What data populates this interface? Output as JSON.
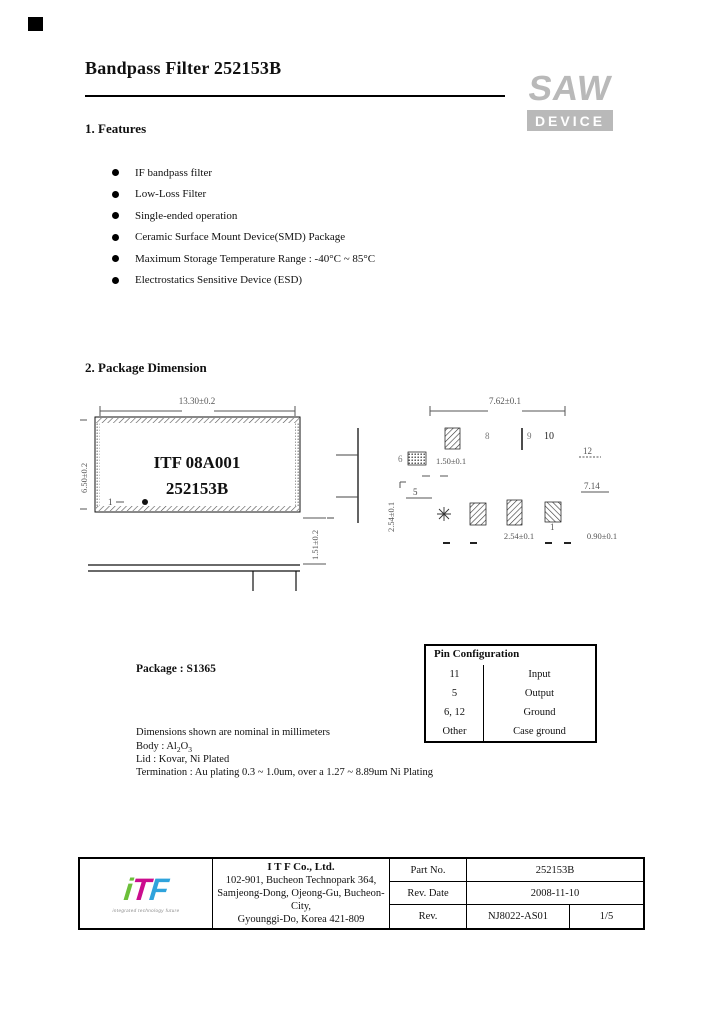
{
  "header": {
    "title": "Bandpass Filter 252153B"
  },
  "saw_logo": {
    "name": "SAW",
    "device": "DEVICE"
  },
  "features": {
    "heading": "1. Features",
    "items": [
      "IF bandpass filter",
      "Low-Loss Filter",
      "Single-ended operation",
      "Ceramic Surface Mount Device(SMD) Package",
      "Maximum Storage Temperature Range : -40°C ~ 85°C",
      "Electrostatics Sensitive Device (ESD)"
    ]
  },
  "package_section": {
    "heading": "2. Package Dimension",
    "package_label": "Package : S1365"
  },
  "drawing": {
    "marking_line1": "ITF 08A001",
    "marking_line2": "252153B",
    "dims": {
      "top_width": "13.30±0.2",
      "left_height": "6.50±0.2",
      "thickness": "1.51±0.2",
      "side_pitch": "2.54±0.1",
      "bottom_width": "7.62±0.1",
      "pad_len": "1.50±0.1",
      "pad_pitch": "2.54±0.1",
      "pad_width": "0.90±0.1",
      "right_dim": "7.14"
    },
    "pins": {
      "p1_mark": "1",
      "p8": "8",
      "p9": "9",
      "p10": "10",
      "p12": "12",
      "p6": "6",
      "p5": "5",
      "p1": "1"
    }
  },
  "pin_table": {
    "title": "Pin Configuration",
    "rows": [
      {
        "pin": "11",
        "function": "Input"
      },
      {
        "pin": "5",
        "function": "Output"
      },
      {
        "pin": "6, 12",
        "function": "Ground"
      },
      {
        "pin": "Other",
        "function": "Case ground"
      }
    ]
  },
  "notes": {
    "dimensions": "Dimensions shown are nominal in millimeters",
    "body_parts": {
      "label": "Body : Al",
      "s1": "2",
      "mid": "O",
      "s2": "3"
    },
    "lid": "Lid : Kovar, Ni Plated",
    "termination": "Termination : Au plating 0.3 ~ 1.0um, over a 1.27 ~ 8.89um Ni Plating"
  },
  "footer": {
    "company_name": "I T F   Co., Ltd.",
    "address1": "102-901, Bucheon Technopark 364,",
    "address2": "Samjeong-Dong, Ojeong-Gu, Bucheon-City,",
    "address3": "Gyounggi-Do, Korea 421-809",
    "part_no_label": "Part No.",
    "part_no": "252153B",
    "rev_date_label": "Rev. Date",
    "rev_date": "2008-11-10",
    "rev_label": "Rev.",
    "rev": "NJ8022-AS01",
    "page": "1/5",
    "logo_i": "i",
    "logo_t": "T",
    "logo_f": "F",
    "logo_tagline": "integrated technology future"
  }
}
